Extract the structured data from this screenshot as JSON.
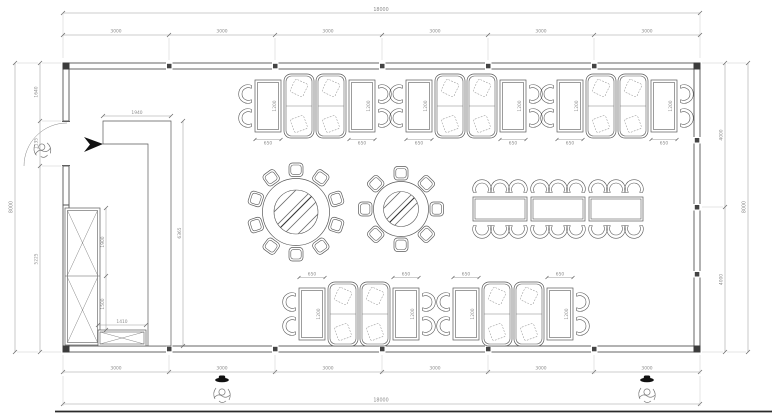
{
  "title": "Restaurant dining room floor plan",
  "colors": {
    "wall_line": "#555555",
    "dimension_text": "#8c8c8c",
    "furniture_line": "#5a5a5a",
    "accent_black": "#111111",
    "background": "#ffffff"
  },
  "dims": {
    "top": {
      "total": "18000",
      "segments": [
        "3000",
        "3000",
        "3000",
        "3000",
        "3000",
        "3000"
      ]
    },
    "bottom": {
      "total": "18000",
      "segments": [
        "3000",
        "3000",
        "3000",
        "3000",
        "3000",
        "3000"
      ]
    },
    "left": {
      "total": "8000",
      "segments": [
        "1640",
        "1135",
        "5225"
      ]
    },
    "right": {
      "total": "8000",
      "segments": [
        "4000",
        "4000"
      ]
    },
    "partition": {
      "width": "1940",
      "height": "6365"
    },
    "cabinet": {
      "upper": "1900",
      "lower": "1500",
      "counter_width": "1410"
    },
    "booth": {
      "table_length": "1200",
      "table_width": "650"
    }
  },
  "furniture": {
    "booth_groups_top": 3,
    "booth_groups_bottom": 2,
    "round_table_large_seats": 10,
    "round_table_small_seats": 8,
    "banquet_table_sections": 3,
    "banquet_table_seats": 18,
    "person_figures": 3
  }
}
